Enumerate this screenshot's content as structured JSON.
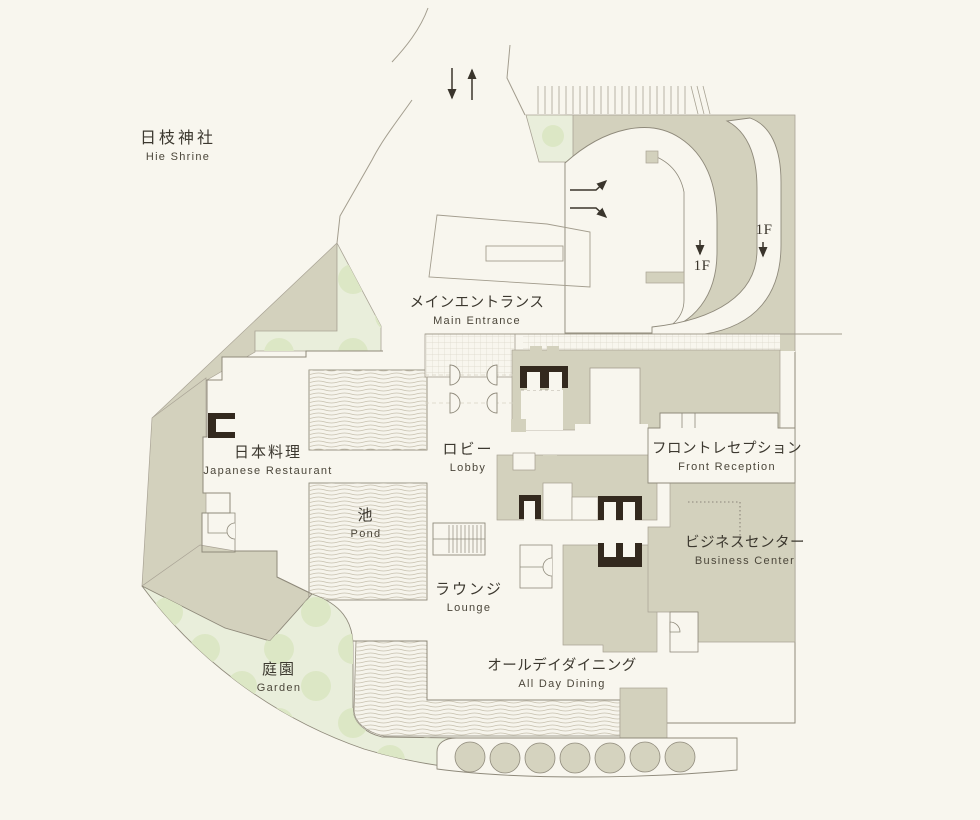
{
  "page": {
    "background": "#f8f6ee"
  },
  "palette": {
    "floor_fill": "#f8f6ee",
    "block_fill": "#d3d1bd",
    "garden_fill": "#e9eedb",
    "garden_tree": "#dce7c5",
    "core_dark": "#33291e",
    "outline": "#8f8a7b",
    "water_line": "#c6c0ae",
    "grid_line": "#dcd8ca",
    "text_jp": "#3c382f",
    "text_en": "#4b463a"
  },
  "labels": {
    "shrine": {
      "jp": "日枝神社",
      "en": "Hie Shrine"
    },
    "main_entrance": {
      "jp": "メインエントランス",
      "en": "Main Entrance"
    },
    "japanese_restaurant": {
      "jp": "日本料理",
      "en": "Japanese Restaurant"
    },
    "lobby": {
      "jp": "ロビー",
      "en": "Lobby"
    },
    "pond": {
      "jp": "池",
      "en": "Pond"
    },
    "front_reception": {
      "jp": "フロントレセプション",
      "en": "Front Reception"
    },
    "business_center": {
      "jp": "ビジネスセンター",
      "en": "Business Center"
    },
    "lounge": {
      "jp": "ラウンジ",
      "en": "Lounge"
    },
    "all_day_dining": {
      "jp": "オールデイダイニング",
      "en": "All Day Dining"
    },
    "garden": {
      "jp": "庭園",
      "en": "Garden"
    },
    "floor_marker_inner": {
      "text": "1F"
    },
    "floor_marker_outer": {
      "text": "1F"
    }
  }
}
